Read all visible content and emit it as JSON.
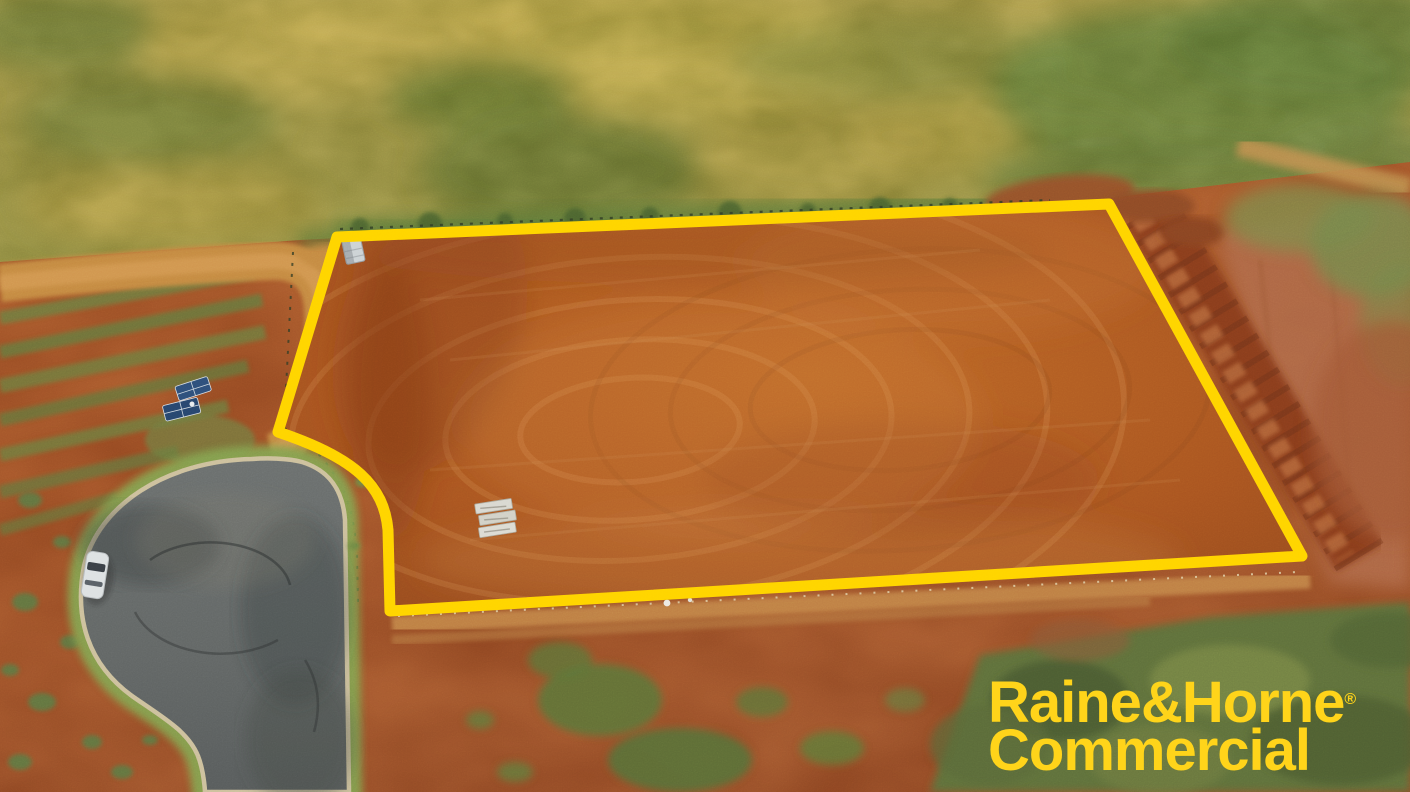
{
  "image": {
    "kind": "aerial-drone-photograph-of-vacant-land",
    "overlay": {
      "boundary_color": "#FFD400"
    },
    "watermark": {
      "line1": "Raine&Horne",
      "registered_mark": "®",
      "line2": "Commercial",
      "color": "#FFD41A"
    }
  }
}
